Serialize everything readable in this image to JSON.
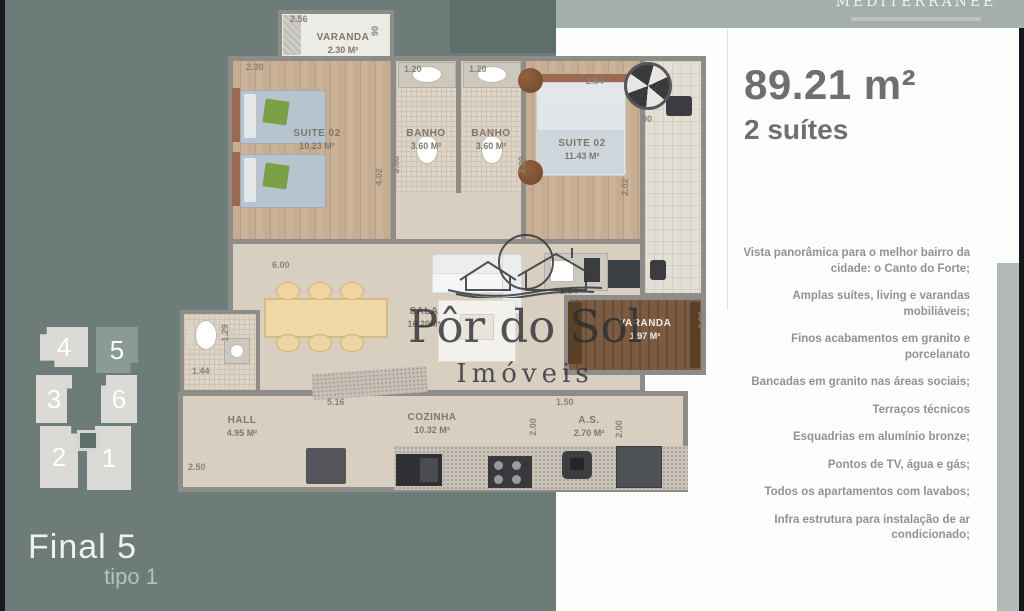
{
  "brand": {
    "logo_text": "MEDITERRANÉE"
  },
  "summary": {
    "area": "89.21 m²",
    "suites": "2 suítes"
  },
  "features": [
    "Vista panorâmica para o melhor bairro da cidade: o Canto do Forte;",
    "Amplas suítes, living e varandas mobiliáveis;",
    "Finos acabamentos em granito e porcelanato",
    "Bancadas em granito nas áreas sociais;",
    "Terraços técnicos",
    "Esquadrias em alumínio bronze;",
    "Pontos de TV, água e gás;",
    "Todos os apartamentos com lavabos;",
    "Infra estrutura para instalação de ar condicionado;"
  ],
  "keyplan": {
    "units": [
      "4",
      "5",
      "3",
      "6",
      "2",
      "1"
    ],
    "final": "Final 5",
    "tipo": "tipo 1"
  },
  "watermark": {
    "name": "Pôr do Sol",
    "sub": "Imóveis"
  },
  "plan": {
    "rooms": {
      "varanda_top": {
        "name": "VARANDA",
        "area": "2.30 M²"
      },
      "suite_left": {
        "name": "SUITE 02",
        "area": "10.23 M²"
      },
      "banho1": {
        "name": "BANHO",
        "area": "3.60 M²"
      },
      "banho2": {
        "name": "BANHO",
        "area": "3.60 M²"
      },
      "suite_right": {
        "name": "SUITE 02",
        "area": "11.43 M²"
      },
      "sala": {
        "name": "SALA",
        "area": "16.20M²"
      },
      "varanda": {
        "name": "VARANDA",
        "area": "1.97 M²"
      },
      "hall": {
        "name": "HALL",
        "area": "4.95 M²"
      },
      "cozinha": {
        "name": "COZINHA",
        "area": "10.32 M²"
      },
      "as": {
        "name": "A.S.",
        "area": "2.70 M²"
      }
    },
    "dims": {
      "varanda_w": "2.56",
      "varanda_side": "90",
      "suite_l_top": "2.30",
      "suite_l_side": "4.02",
      "banho1_top": "1.20",
      "banho2_top": "1.20",
      "banho1_side": "3.00",
      "banho2_side": "3.00",
      "suite_r_top": "2.54",
      "suite_r_side": "2.02",
      "compass": "90",
      "sala_top": "6.00",
      "counter": "1.84",
      "terrace_side": "6.86",
      "kitchen_top": "5.16",
      "as_top": "1.50",
      "as_left": "2.00",
      "as_right": "2.00",
      "hall_bottom": "2.50",
      "wc_bottom": "1.44",
      "wc_side": "1.29"
    }
  }
}
